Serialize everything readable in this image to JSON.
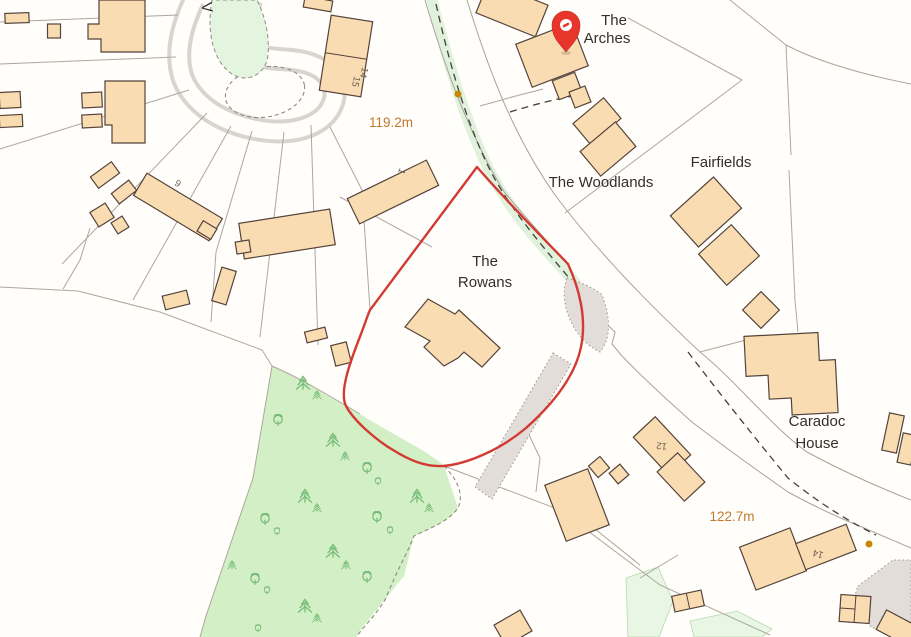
{
  "map": {
    "place_labels": {
      "arches_1": "The",
      "arches_2": "Arches",
      "woodlands": "The Woodlands",
      "fairfields": "Fairfields",
      "rowans_1": "The",
      "rowans_2": "Rowans",
      "caradoc_1": "Caradoc",
      "caradoc_2": "House",
      "street_partial": "V"
    },
    "elevation_labels": {
      "e1": "119.2m",
      "e2": "122.7m"
    },
    "building_numbers": {
      "n14a": "14",
      "n15": "15",
      "n1": "1",
      "n9": "9",
      "n12": "12",
      "n14b": "14"
    },
    "colors": {
      "building_fill": "#FADCB2",
      "building_stroke": "#54433A",
      "boundary_red": "#D23B33",
      "pin_red": "#E8352B",
      "woodland_green": "#D3EFC6",
      "verge_green": "#E0F2DC",
      "tree_green": "#76BB76",
      "road_gray": "#D9D4CE",
      "elevation_text": "#BF7A2E",
      "dot_orange": "#C8860B"
    }
  }
}
